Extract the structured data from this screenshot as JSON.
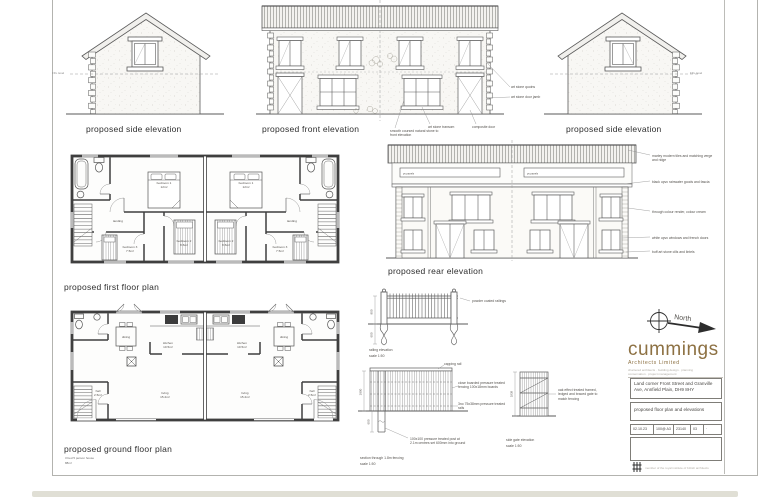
{
  "sheet": {
    "titles": {
      "side_left": "proposed side elevation",
      "front": "proposed front elevation",
      "side_right": "proposed side elevation",
      "first_floor": "proposed first floor plan",
      "rear": "proposed rear elevation",
      "ground_floor": "proposed ground floor plan",
      "ground_floor_note_1": "3 bed 5 person house",
      "ground_floor_note_2": "88m²",
      "railing": "railing elevation",
      "railing_scale": "scale 1:50",
      "fence": "section through 1.8m fencing",
      "fence_scale": "scale 1:50",
      "gate": "side gate elevation",
      "gate_scale": "scale 1:50"
    },
    "levels": {
      "ffl_left": "FFL level",
      "ffl_right": "FFL level"
    },
    "front_notes": {
      "stone": "smooth coursed natural stone to front elevation",
      "transom": "art stone transom",
      "door": "composite door",
      "quoins": "art stone quoins",
      "jamb": "art stone door jamb"
    },
    "rear_notes": [
      "marley modern tiles and matching verge and ridge",
      "black upvc rainwater goods and fascia",
      "through colour render, colour cream",
      "white upvc windows and french doors",
      "buff art stone cills and lintels"
    ],
    "rear_panels": {
      "left": "pv panels",
      "right": "pv panels"
    },
    "rooms_first": {
      "bedroom1": "bedroom 1",
      "bedroom1_area": "12m²",
      "bedroom2": "bedroom 2",
      "bedroom2_area": "8.5m²",
      "bedroom3": "bedroom 3",
      "bedroom3_area": "7.5m²",
      "landing": "landing"
    },
    "rooms_ground": {
      "dining": "dining",
      "kitchen": "kitchen",
      "kitchen_area": "10.5m²",
      "living": "living",
      "living_area": "15.2m²",
      "hall": "hall",
      "hall_area": "2.5m²"
    },
    "fence_notes": {
      "railings": "powder coated railings",
      "capping": "capping rail",
      "boards": "close boarded pressure treated fencing 100x18mm boards",
      "rails": "3no 75x38mm pressure treated rails",
      "post": "100x100 pressure treated post at 2.1m centres set 600mm into ground",
      "gate": "oak effect treated framed, ledged and braced gate to match fencing"
    },
    "dims": {
      "railing_h": "900",
      "railing_post": "600",
      "fence_h": "1800",
      "fence_post": "600",
      "gate_h": "1838"
    }
  },
  "titleblock": {
    "north": "North",
    "brand": "cummings",
    "brand_sub": "Architects Limited",
    "brand_contact_1": "chartered architects · building design · planning",
    "brand_contact_2": "conservation · project management",
    "project": "Land corner Front Street and Granville Ave, Annfield Plain, DH9 8HY",
    "drawing": "proposed floor plan and elevations",
    "row": {
      "date": "02.10.23",
      "scale": "100@ A3",
      "job": "23140",
      "rev": "03",
      "extra": "·"
    },
    "footer": "member of the royal institute of british architects",
    "brand_color": "#8d7143"
  }
}
